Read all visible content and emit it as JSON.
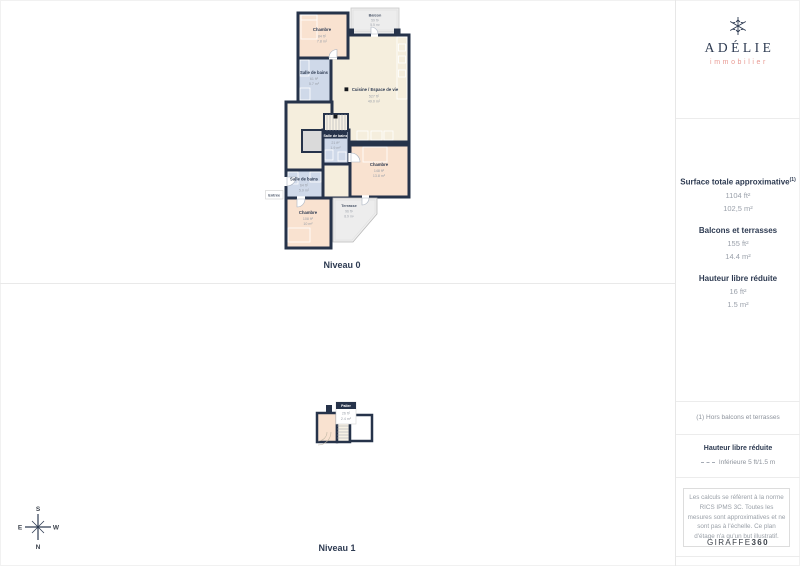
{
  "page": {
    "niveau0_label": "Niveau 0",
    "niveau1_label": "Niveau 1"
  },
  "logo": {
    "brand": "ADÉLIE",
    "subtitle": "immobilier"
  },
  "metrics": {
    "surface_title": "Surface totale approximative",
    "surface_sup": "(1)",
    "surface_ft": "1104 ft²",
    "surface_m": "102,5 m²",
    "balconies_title": "Balcons et terrasses",
    "balconies_ft": "155 ft²",
    "balconies_m": "14.4 m²",
    "height_title": "Hauteur libre réduite",
    "height_ft": "16 ft²",
    "height_m": "1.5 m²"
  },
  "notes": {
    "footnote": "(1) Hors balcons et terrasses",
    "height_legend_title": "Hauteur libre réduite",
    "height_legend_value": "Inférieure 5 ft/1.5 m",
    "disclaimer": "Les calculs se réfèrent à la norme RICS IPMS 3C. Toutes les mesures sont approximatives et ne sont pas à l'échelle. Ce plan d'étage n'a qu'un but illustratif.",
    "brand_normal": "GIRAFFE",
    "brand_bold": "360"
  },
  "compass": {
    "top": "S",
    "bottom": "N",
    "left": "E",
    "right": "W"
  },
  "rooms0": {
    "chambre_tl": {
      "name": "Chambre",
      "ft": "84 ft²",
      "m": "7.8 m²"
    },
    "balcon": {
      "name": "Balcon",
      "ft": "59 ft²",
      "m": "5.5 m²"
    },
    "sdb_tl": {
      "name": "Salle de bains",
      "ft": "61 ft²",
      "m": "5.7 m²"
    },
    "cuisine": {
      "name": "Cuisine / Espace de vie",
      "ft": "527 ft²",
      "m": "49.0 m²"
    },
    "sdb_mid": {
      "name": "Salle de bains",
      "ft": "21 ft²",
      "m": "1.9 m²"
    },
    "chambre_right": {
      "name": "Chambre",
      "ft": "148 ft²",
      "m": "13.8 m²"
    },
    "sdb_left": {
      "name": "Salle de bains",
      "ft": "64 ft²",
      "m": "5.9 m²"
    },
    "entree": {
      "name": "Entrée"
    },
    "chambre_bottom": {
      "name": "Chambre",
      "ft": "108 ft²",
      "m": "10 m²"
    },
    "terrasse": {
      "name": "Terrasse",
      "ft": "96 ft²",
      "m": "8.9 m²"
    }
  },
  "rooms1": {
    "palier": {
      "name": "Palier",
      "ft": "26 ft²",
      "m": "2.4 m²"
    }
  }
}
